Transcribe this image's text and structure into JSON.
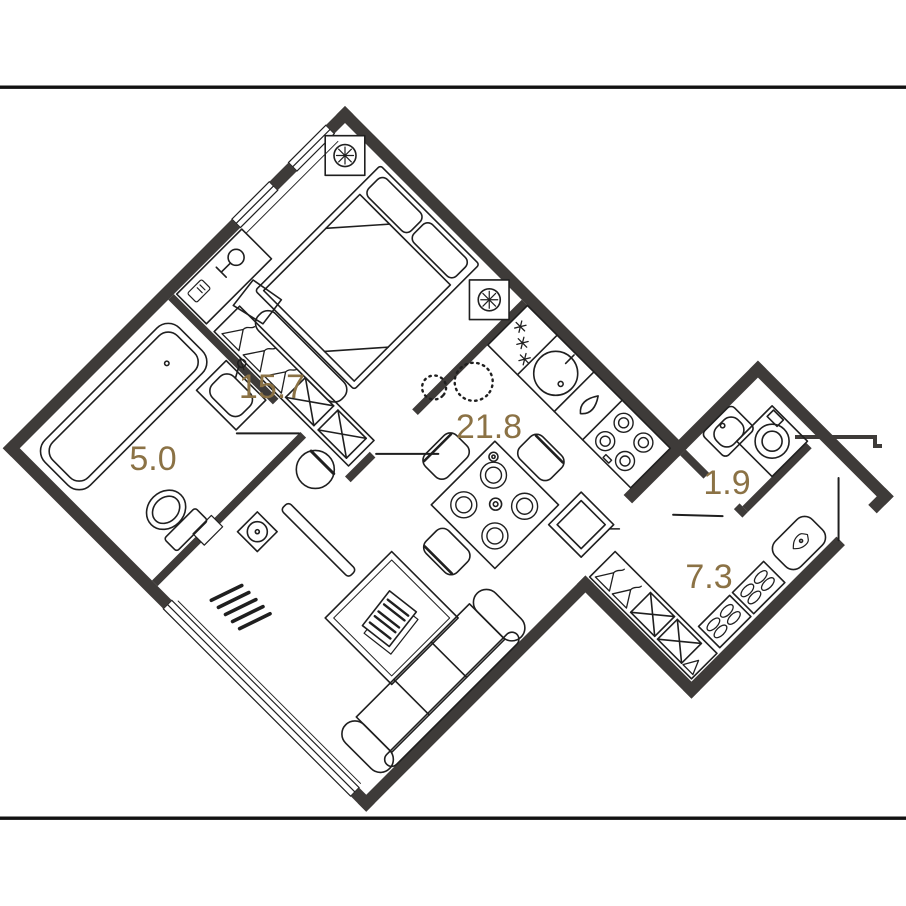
{
  "title": "apartment-floor-plan",
  "colors": {
    "wall": "#3E3B39",
    "furniture_line": "#1F1F1F",
    "label": "#8B7245",
    "frame_line": "#111111",
    "background": "#FFFFFF"
  },
  "rooms": [
    {
      "id": "bedroom",
      "area_label": "15.7"
    },
    {
      "id": "bathroom",
      "area_label": "5.0"
    },
    {
      "id": "living-kitchen",
      "area_label": "21.8"
    },
    {
      "id": "wc",
      "area_label": "1.9"
    },
    {
      "id": "hallway",
      "area_label": "7.3"
    }
  ],
  "icons": [
    "vent-shaft-icon",
    "bed-icon",
    "pillow-icon",
    "bed-bench-icon",
    "desk-icon",
    "desk-lamp-icon",
    "desk-chair-icon",
    "wardrobe-hanger-icon",
    "drawer-box-icon",
    "side-chair-icon",
    "ceiling-light-icon",
    "kitchen-vent-icon",
    "kitchen-sink-icon",
    "dishwasher-icon",
    "hob-icon",
    "dining-table-icon",
    "plate-icon",
    "dining-chair-icon",
    "serving-table-icon",
    "rug-icon",
    "magazine-icon",
    "sofa-icon",
    "radiator-icon",
    "tv-bench-icon",
    "floor-lamp-icon",
    "bathtub-icon",
    "washbasin-icon",
    "toilet-icon",
    "door-leaf-icon",
    "washing-machine-icon",
    "corner-basin-icon",
    "entrance-bench-icon",
    "shoe-rack-icon",
    "window-icon"
  ]
}
